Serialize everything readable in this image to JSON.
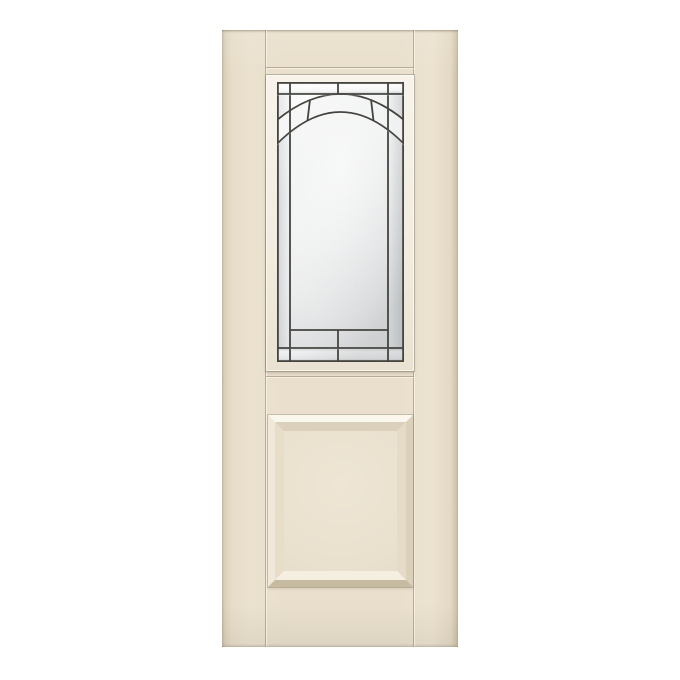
{
  "page": {
    "description": "Product photo of a smooth fiberglass exterior door, almond finish, half-lite decorative glass on top and one raised square panel below, on a plain white background",
    "visible_text": ""
  },
  "product": {
    "type": "exterior-door",
    "orientation": "front view, full slab",
    "top_section": {
      "name": "decorative-half-lite-glass",
      "frame": "flat painted lite frame",
      "pattern": "beveled clear glass border columns and bands, double arch band of textured glass, large granite-textured center field, segmented bottom bands",
      "caming": "dark zinc caming lines"
    },
    "bottom_section": {
      "name": "raised-panel",
      "shape": "square raised panel with mitered molding"
    }
  },
  "palette": {
    "background": "#ffffff",
    "door-base": "#e9dfcc",
    "door-edge": "#c9bda5",
    "frame-white": "#f7f3ea",
    "caming": "#45443f",
    "glass-clear": "#fbfcfc",
    "glass-textured": "#e9eaea",
    "panel-highlight": "#faf7ef",
    "panel-shadow": "#c6baa1"
  }
}
